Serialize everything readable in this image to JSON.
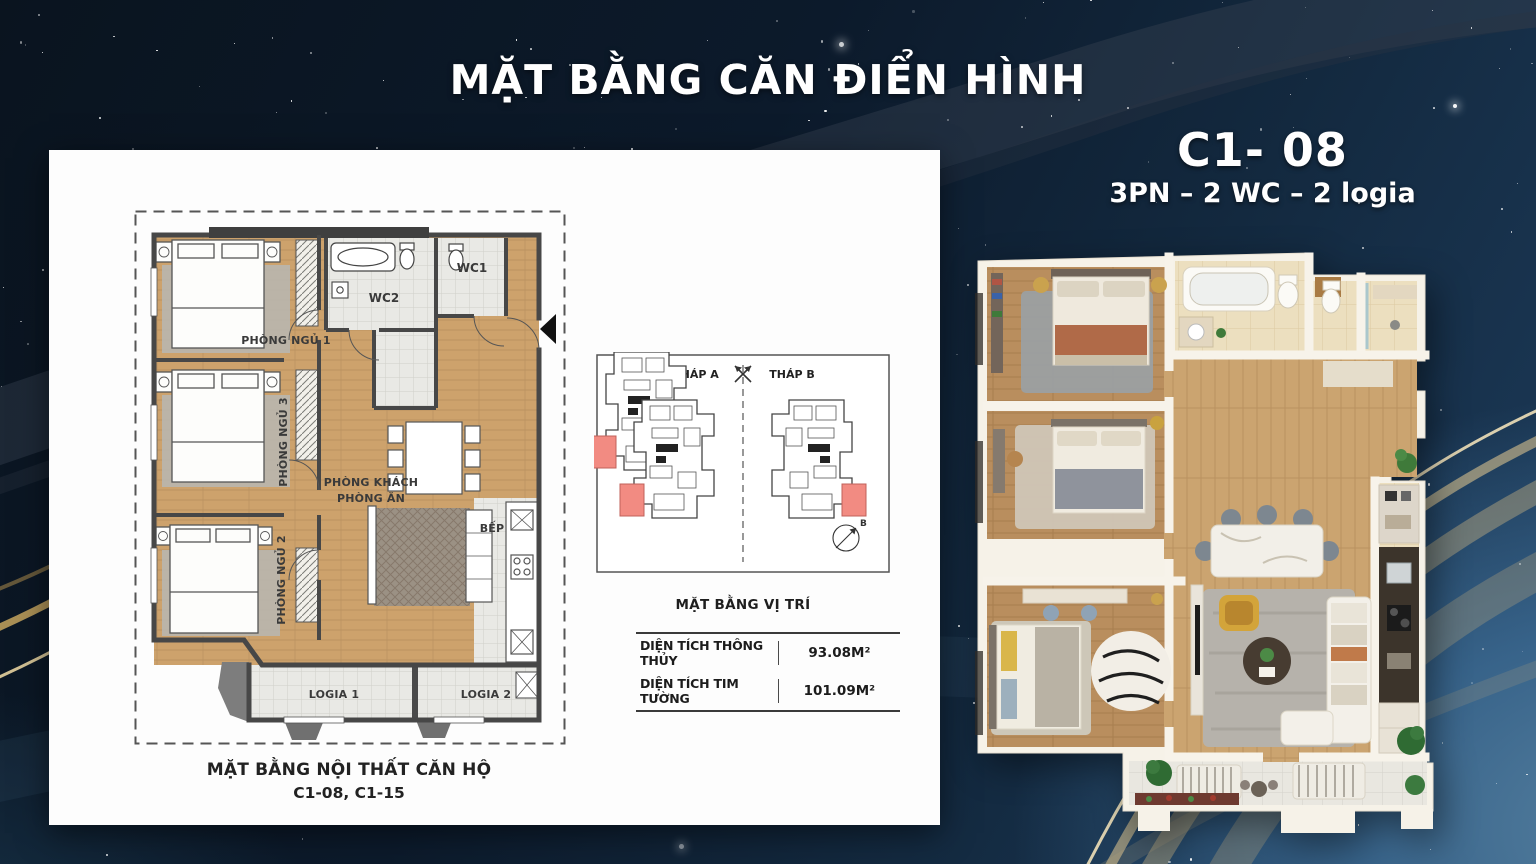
{
  "title": "MẶT BẰNG CĂN ĐIỂN HÌNH",
  "unit": {
    "code": "C1- 08",
    "spec": "3PN – 2 WC – 2 logia"
  },
  "floorplan2d": {
    "caption_line1": "MẶT BẰNG NỘI THẤT CĂN HỘ",
    "caption_line2": "C1-08, C1-15",
    "rooms": {
      "bedroom1": "PHÒNG NGỦ 1",
      "bedroom2": "PHÒNG NGỦ 2",
      "bedroom3": "PHÒNG NGỦ 3",
      "living": "PHÒNG KHÁCH",
      "dining": "PHÒNG ĂN",
      "kitchen": "BẾP",
      "wc1": "WC1",
      "wc2": "WC2",
      "logia1": "LOGIA 1",
      "logia2": "LOGIA 2"
    }
  },
  "location": {
    "caption": "MẶT BẰNG VỊ TRÍ",
    "tower_a": "THÁP A",
    "tower_b": "THÁP B",
    "compass_label": "B",
    "highlight_color": "#f28b82"
  },
  "areas": {
    "rows": [
      {
        "label": "DIỆN TÍCH THÔNG THỦY",
        "value": "93.08M²"
      },
      {
        "label": "DIỆN TÍCH TIM TƯỜNG",
        "value": "101.09M²"
      }
    ]
  },
  "colors": {
    "sky_dark": "#0b1624",
    "sky_light": "#3f6c95",
    "gold_ribbon": "#d8c49a",
    "unit_highlight": "#f28b82",
    "wood_floor": "#c8a26c"
  }
}
